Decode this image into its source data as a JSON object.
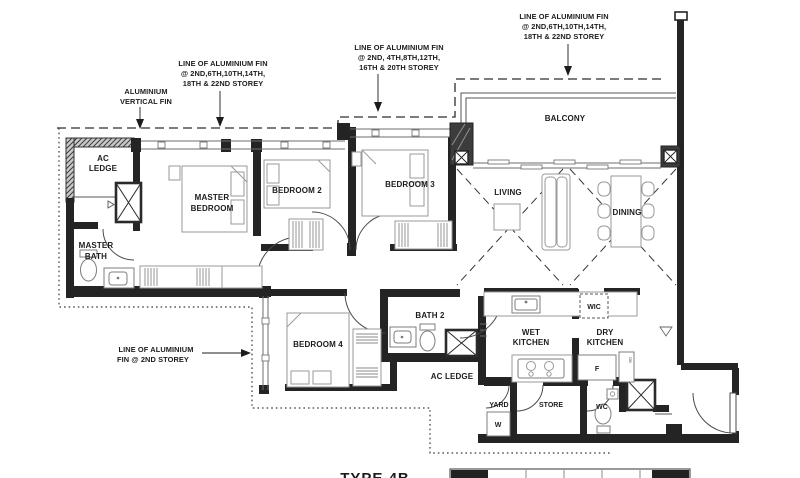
{
  "drawing": {
    "annotations": {
      "alu_vertical_fin": {
        "lines": [
          "ALUMINIUM",
          "VERTICAL FIN"
        ]
      },
      "fin_left": {
        "lines": [
          "LINE OF ALUMINIUM FIN",
          "@ 2ND,6TH,10TH,14TH,",
          "18TH & 22ND STOREY"
        ]
      },
      "fin_mid": {
        "lines": [
          "LINE OF ALUMINIUM FIN",
          "@ 2ND, 4TH,8TH,12TH,",
          "16TH & 20TH STOREY"
        ]
      },
      "fin_right": {
        "lines": [
          "LINE OF ALUMINIUM FIN",
          "@ 2ND,6TH,10TH,14TH,",
          "18TH & 22ND STOREY"
        ]
      },
      "fin_2nd_storey": {
        "lines": [
          "LINE OF ALUMINIUM",
          "FIN @ 2ND STOREY"
        ]
      }
    },
    "rooms": {
      "ac_ledge_top": {
        "lines": [
          "AC",
          "LEDGE"
        ]
      },
      "master_bedroom": {
        "lines": [
          "MASTER",
          "BEDROOM"
        ]
      },
      "master_bath": {
        "lines": [
          "MASTER",
          "BATH"
        ]
      },
      "bedroom2": {
        "label": "BEDROOM 2"
      },
      "bedroom3": {
        "label": "BEDROOM 3"
      },
      "bedroom4": {
        "label": "BEDROOM 4"
      },
      "living": {
        "label": "LIVING"
      },
      "dining": {
        "label": "DINING"
      },
      "balcony": {
        "label": "BALCONY"
      },
      "bath2": {
        "label": "BATH 2"
      },
      "wic": {
        "label": "WIC"
      },
      "wet_kitchen": {
        "lines": [
          "WET",
          "KITCHEN"
        ]
      },
      "dry_kitchen": {
        "lines": [
          "DRY",
          "KITCHEN"
        ]
      },
      "ac_ledge_bottom": {
        "label": "AC LEDGE"
      },
      "yard": {
        "label": "YARD"
      },
      "store": {
        "label": "STORE"
      },
      "wc": {
        "label": "WC"
      }
    },
    "appliances": {
      "washer": "W",
      "fridge": "F",
      "db_riser": "DB"
    },
    "footer": {
      "type_label": "TYPE 4B"
    },
    "colors": {
      "wall": "#242424",
      "furniture": "#9a9a9a",
      "annotation": "#1c1c1c",
      "background": "#ffffff"
    }
  }
}
